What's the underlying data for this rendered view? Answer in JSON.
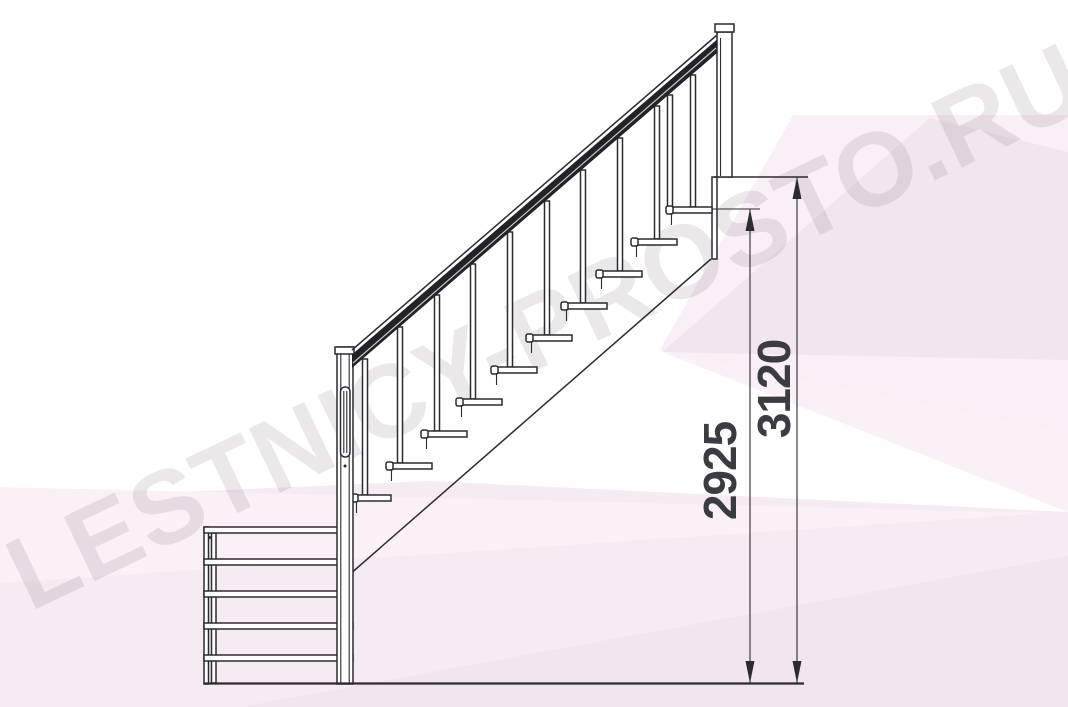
{
  "watermark": {
    "text": "LESTNICY-PROSTO.RU"
  },
  "dimensions": {
    "tread_top_height": "2925",
    "total_height": "3120"
  },
  "stairs": {
    "upper_tread_count": 10,
    "lower_front_step_count": 5,
    "baluster_count": 11,
    "newel_post_count": 2
  },
  "colors": {
    "paper": "#ffffff",
    "line": "#2b2b30",
    "rail": "#232327",
    "dim-text": "#3b3b42",
    "wm-text": "#6a5564",
    "pink-a": "#f5ebf2",
    "pink-b": "#f9eff6",
    "pink-c": "#f2e6ee",
    "pink-d": "#faf1f7"
  }
}
